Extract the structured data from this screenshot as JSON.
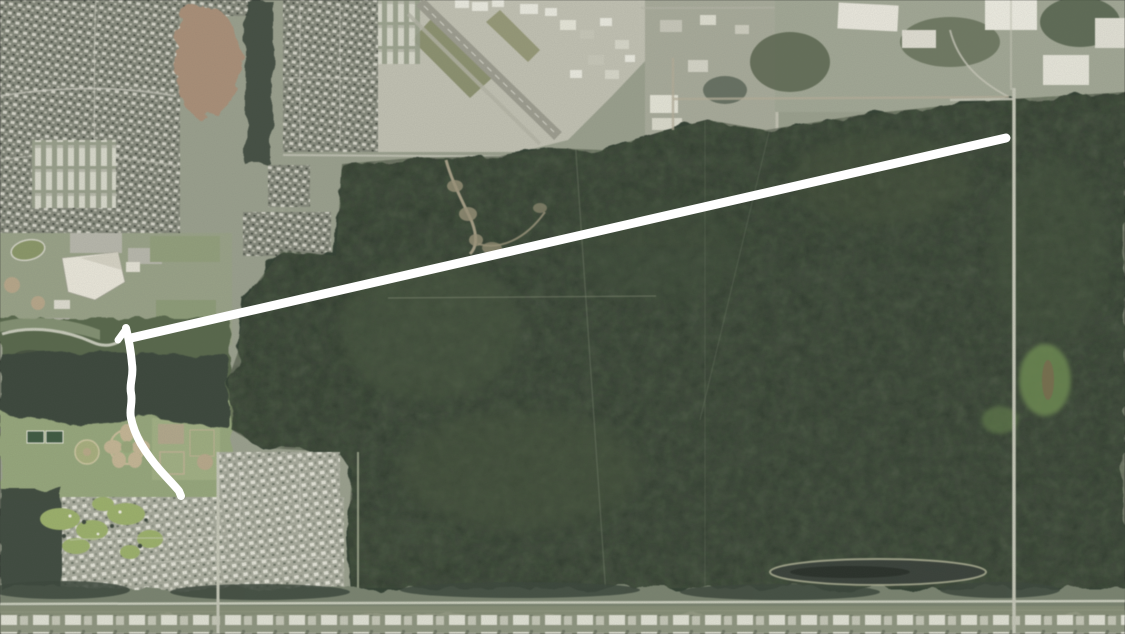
{
  "meta": {
    "kind": "aerial-satellite-screenshot",
    "width_px": 1125,
    "height_px": 634,
    "visible_text": "none"
  },
  "palette": {
    "base_land": "#9ba18e",
    "forest": "#333f33",
    "forest_edge_blob": "#3a473a",
    "forest_speckle_light": "#5c6c4c",
    "forest_speckle_haze": "#87927a",
    "forest_speckle_dark": "#1c241c",
    "residential_dark": "#868a7c",
    "residential_light": "#a9ac9d",
    "dirt_lot": "#ab9078",
    "airport_pavement": "#c3c3b4",
    "runway": "#9e9e90",
    "golf_green": "#9db26b",
    "road_light": "#c6c8b8",
    "corridor_band": "#7a8470",
    "pond_dark": "#39413a",
    "annotation_white": "#ffffff"
  },
  "annotation": {
    "color": "#ffffff",
    "route_line": {
      "path": "M131,338 L1006,138",
      "stroke_width": 9,
      "start_xy": "131,338",
      "end_xy": "1006,138"
    },
    "route_squiggle": {
      "path": "M126,328 C129,340 131,352 132,364 C134,377 129,383 131,393 C133,403 129,409 131,418 C133,428 136,435 141,444 C147,454 153,462 160,470 C167,478 174,485 179,491 L181,496",
      "stroke_width": 8,
      "start_xy": "126,328",
      "end_xy": "181,496"
    },
    "route_flare": {
      "path": "M126,329 L118,340",
      "stroke_width": 7
    }
  },
  "map_features": [
    {
      "id": "residential-northwest",
      "label": "dense residential subdivisions (north-west)"
    },
    {
      "id": "dirt-lot",
      "label": "cleared brown dirt lot"
    },
    {
      "id": "apartment-rows",
      "label": "apartment / townhome rows"
    },
    {
      "id": "school-campus",
      "label": "school campus with track and ball fields"
    },
    {
      "id": "airfield",
      "label": "airfield with diagonal runway and hangars"
    },
    {
      "id": "industrial-east-of-airfield",
      "label": "industrial buildings east of airfield"
    },
    {
      "id": "homesteads-northeast",
      "label": "rural homesteads and fields (north-east)"
    },
    {
      "id": "forest-tract",
      "label": "large dark forest tract (center and east)"
    },
    {
      "id": "sports-park",
      "label": "community sports park with tennis courts and flower-shaped garden"
    },
    {
      "id": "golf-community",
      "label": "golf-course residential community (south-west)"
    },
    {
      "id": "north-south-road",
      "label": "long straight north-south road (east side)"
    },
    {
      "id": "corridor-road",
      "label": "east-west road corridor near bottom"
    },
    {
      "id": "industrial-strip",
      "label": "industrial strip along bottom edge"
    },
    {
      "id": "pond",
      "label": "elongated dark pond (south-east)"
    },
    {
      "id": "route-annotation",
      "label": "white drawn route: straight segment plus hand-drawn wiggly segment"
    }
  ]
}
